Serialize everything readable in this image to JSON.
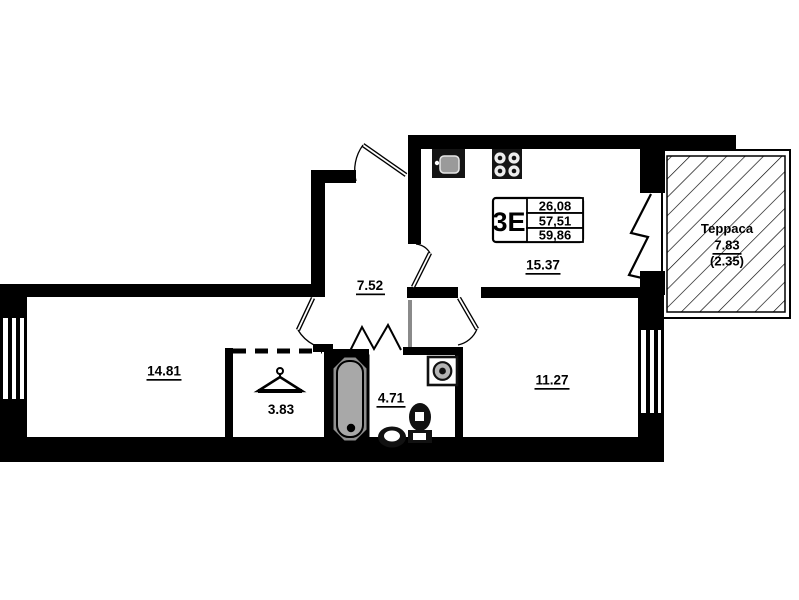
{
  "floorplan": {
    "legend": {
      "type": "3Е",
      "areas": [
        "26,08",
        "57,51",
        "59,86"
      ]
    },
    "rooms": {
      "hallway": "7.52",
      "kitchen_living": "15.37",
      "living_room": "14.81",
      "wardrobe": "3.83",
      "bathroom": "4.71",
      "bedroom": "11.27"
    },
    "terrace": {
      "title": "Терраса",
      "area": "7.83",
      "area_reduced": "(2.35)"
    },
    "icons": {
      "kitchen_sink": "sink-icon",
      "stove": "stove-icon",
      "washing_machine": "washing-machine-icon",
      "bathtub": "bathtub-icon",
      "toilet": "toilet-icon",
      "bath_sink": "sink-icon",
      "hanger": "hanger-icon"
    },
    "colors": {
      "wall": "#000000",
      "background": "#ffffff",
      "fixture_gray": "#9a9a9a"
    }
  }
}
